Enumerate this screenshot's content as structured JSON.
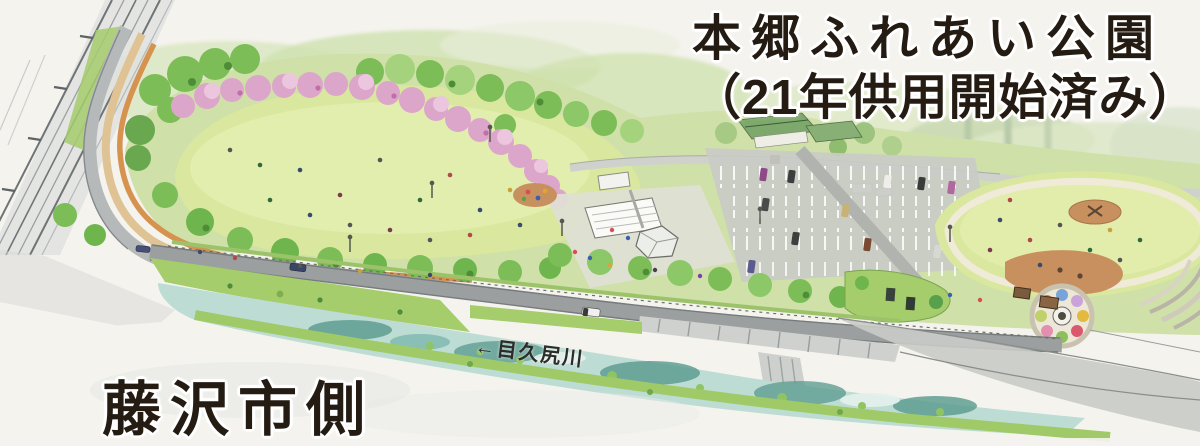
{
  "labels": {
    "park_title_line1": "本郷ふれあい公園",
    "park_title_line2": "（21年供用開始済み）",
    "fujisawa_side": "藤沢市側",
    "river_name": "←目久尻川"
  },
  "palette": {
    "paper": "#f4f3ee",
    "ink": "#241b13",
    "lawn": "#d9e89e",
    "lawn-light": "#e4efb0",
    "tree-green": "#7cbd57",
    "tree-dark": "#4e8c38",
    "cherry-pink": "#dca6cb",
    "cherry-light": "#ecc6de",
    "river-teal": "#5f9d92",
    "river-light": "#bcdcd4",
    "bank-green": "#a5cd6c",
    "road-gray": "#9a9ea0",
    "road-light": "#c9cbc6",
    "path-tan": "#e0c394",
    "path-orange": "#d6924f",
    "plaza": "#dfe0d5",
    "soil-brown": "#c8905f",
    "roof-green": "#7ea96c"
  },
  "scene": {
    "type": "watercolor-aerial-illustration",
    "features": [
      "elevated-railway",
      "great-lawn",
      "cherry-blossom-row",
      "west-promenade-paths",
      "central-plaza-pavilions",
      "small-playground",
      "parking-lot",
      "temple-building",
      "east-lawn",
      "brown-playgrounds",
      "flower-garden-circle",
      "amphitheater-steps",
      "entrance-island",
      "riverside-road",
      "concrete-revetment",
      "mekujiri-river"
    ]
  }
}
